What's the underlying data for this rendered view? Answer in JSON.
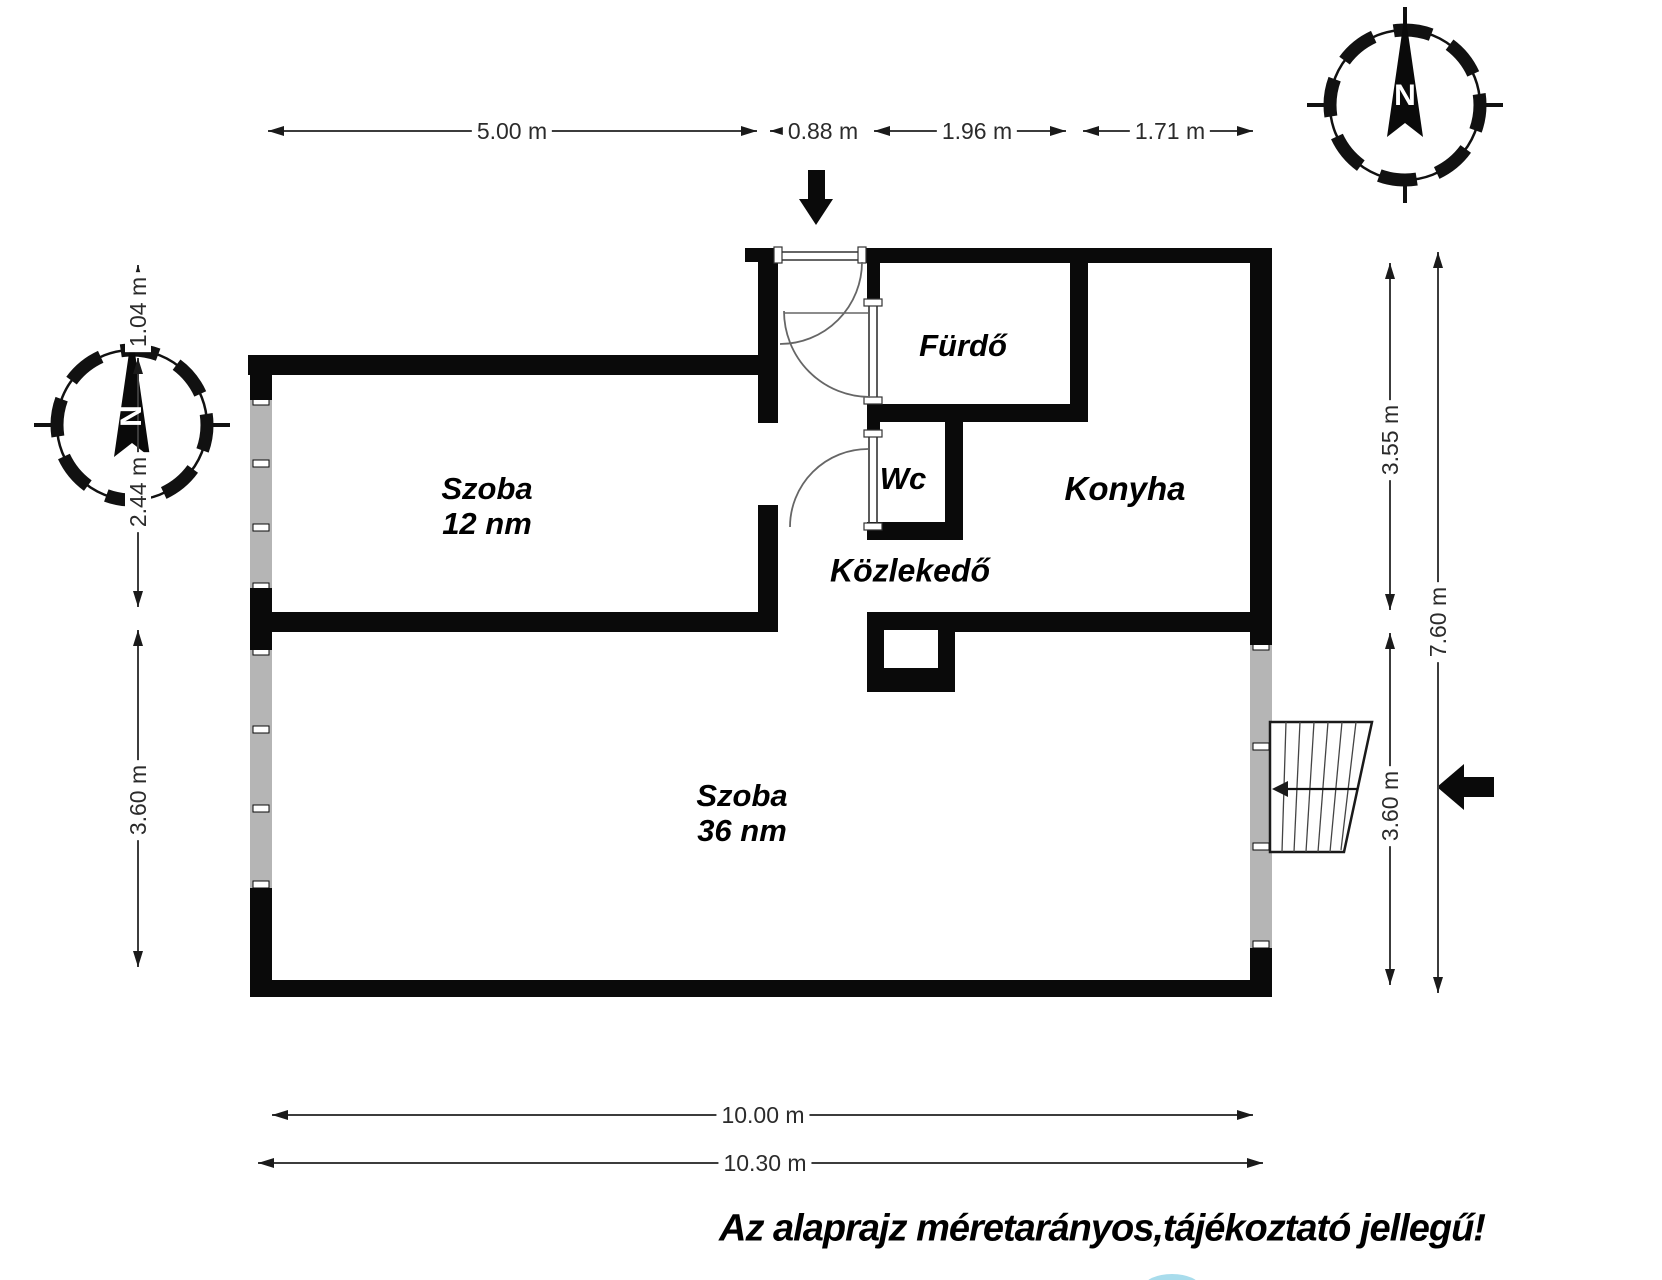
{
  "footer": {
    "disclaimer": "Az alaprajz méretarányos,tájékoztató jellegű!"
  },
  "compass": {
    "north_label": "N"
  },
  "rooms": {
    "szoba12": {
      "name": "Szoba",
      "area": "12 nm"
    },
    "szoba36": {
      "name": "Szoba",
      "area": "36 nm"
    },
    "furdo": {
      "name": "Fürdő"
    },
    "wc": {
      "name": "Wc"
    },
    "konyha": {
      "name": "Konyha"
    },
    "kozlekedo": {
      "name": "Közlekedő"
    }
  },
  "dimensions": {
    "top": {
      "szoba12_width": "5.00 m",
      "entry_width": "0.88 m",
      "furdo_width": "1.96 m",
      "konyha_width": "1.71 m"
    },
    "left": {
      "offset": "1.04 m",
      "szoba12_height": "2.44 m",
      "szoba36_height": "3.60 m"
    },
    "right": {
      "upper_height": "3.55 m",
      "lower_height": "3.60 m",
      "total_height": "7.60 m"
    },
    "bottom": {
      "inner_width": "10.00 m",
      "outer_width": "10.30 m"
    }
  },
  "colors": {
    "wall": "#0a0a0a",
    "window": "#b5b5b5",
    "dimension": "#3c3c3c",
    "artifact_blue": "#a8dcec"
  }
}
